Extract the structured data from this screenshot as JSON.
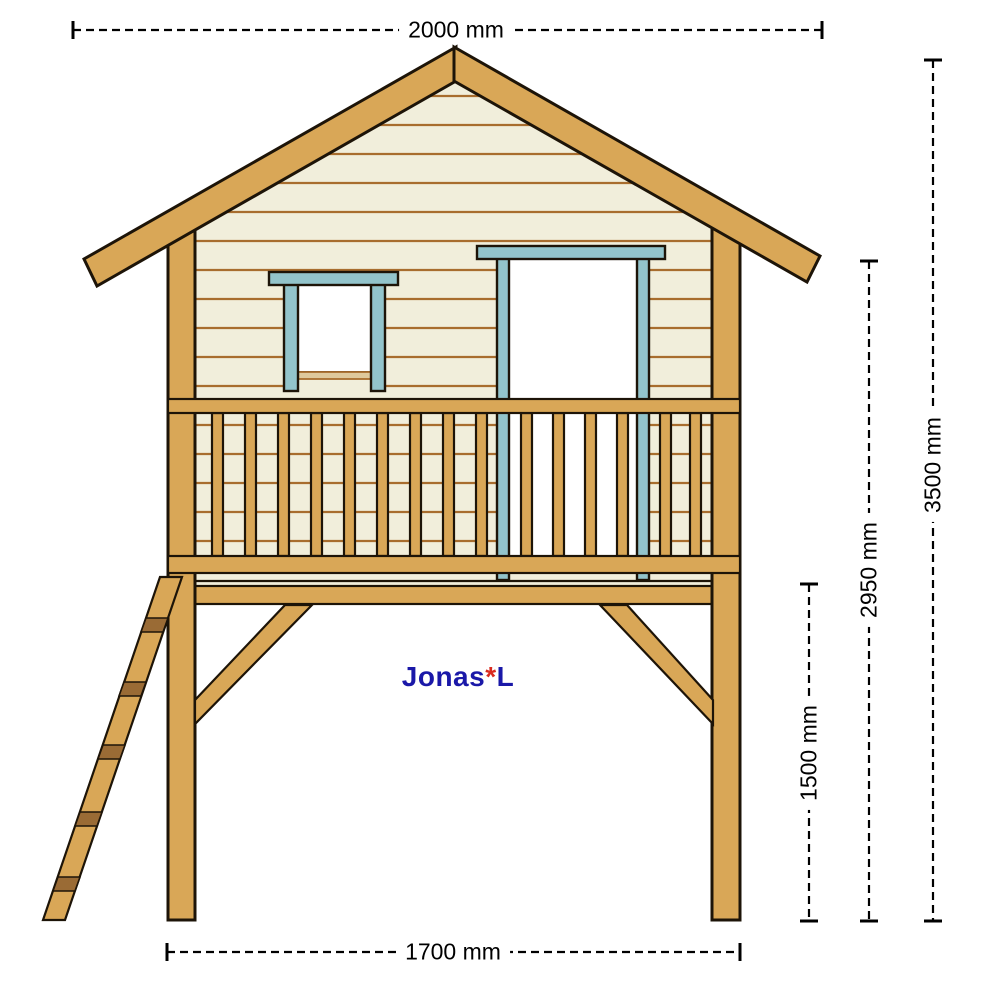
{
  "drawing": {
    "type": "playhouse-front-elevation",
    "brand": {
      "name": "Jonas",
      "mark": "*",
      "letter": "L"
    },
    "dims": {
      "width_top": "2000 mm",
      "width_bottom": "1700 mm",
      "height_total": "3500 mm",
      "height_upper": "2950 mm",
      "height_stilts": "1500 mm"
    },
    "colors": {
      "bg": "#ffffff",
      "wood": "#d9a757",
      "wood_dark": "#9a6b35",
      "outline": "#1d1408",
      "wall": "#f1eedb",
      "siding_line": "#a86d2e",
      "window_blue": "#93c4cb",
      "dim_color": "#000000",
      "brand_navy": "#1a18a8",
      "brand_red": "#d92b20"
    }
  }
}
